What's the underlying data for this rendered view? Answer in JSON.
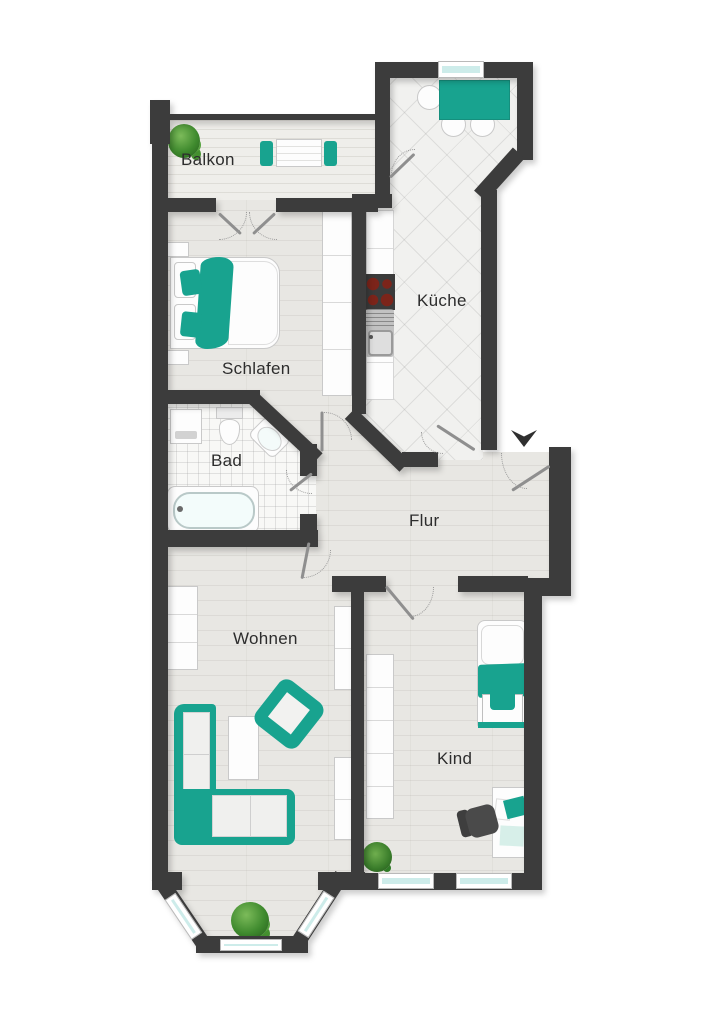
{
  "rooms": {
    "balkon": "Balkon",
    "schlafen": "Schlafen",
    "kueche": "Küche",
    "bad": "Bad",
    "flur": "Flur",
    "wohnen": "Wohnen",
    "kind": "Kind"
  },
  "entrance": {
    "symbol": "arrow-down"
  },
  "colors": {
    "accent": "#18a38f",
    "wall": "#3c3c3c",
    "glass": "#cdecea",
    "wood": "#e8e7e3",
    "balcony_wood": "#efeeea",
    "kitchen_tile": "#f1f1ef",
    "bath_tile": "#f8f8f6",
    "label": "#2d2d2d",
    "burner": "#7c241a",
    "chair_dark": "#4a4a4a",
    "plant": "#4f9b3f",
    "door": "#8f8f8f"
  },
  "furniture": {
    "balkon": [
      "potted-plant",
      "table",
      "chair",
      "chair"
    ],
    "kueche": [
      "dining-table",
      "chair",
      "chair",
      "chair",
      "counter",
      "stove",
      "sink",
      "window"
    ],
    "schlafen": [
      "double-bed",
      "pillow",
      "pillow",
      "wardrobe",
      "nightstand",
      "nightstand"
    ],
    "bad": [
      "washing-machine",
      "toilet",
      "sink",
      "bathtub"
    ],
    "wohnen": [
      "corner-sofa",
      "coffee-table",
      "armchair",
      "shelf",
      "shelf",
      "shelf",
      "bay-plant"
    ],
    "kind": [
      "single-bed",
      "desk",
      "office-chair",
      "laptop",
      "wardrobe",
      "plant",
      "window",
      "window"
    ]
  }
}
